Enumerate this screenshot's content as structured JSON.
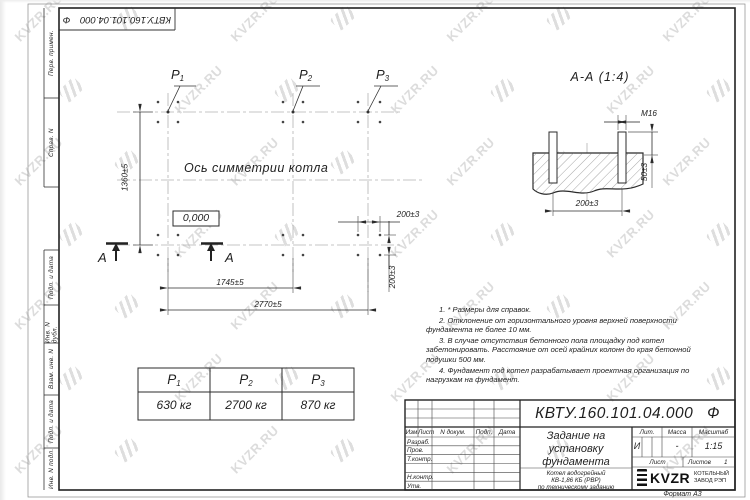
{
  "watermark": {
    "text": "KVZR.RU"
  },
  "doc_number": "КВТУ.160.101.04.000",
  "doc_suffix": "Ф",
  "sidebar": {
    "cells": [
      "Перв. примен.",
      "Справ. N",
      "Подп. и дата",
      "Инв. N дубл.",
      "Взам. инв. N",
      "Подп. и дата",
      "Инв. N подл."
    ]
  },
  "plan": {
    "loads": [
      {
        "base": "P",
        "sub": "1"
      },
      {
        "base": "P",
        "sub": "2"
      },
      {
        "base": "P",
        "sub": "3"
      }
    ],
    "axis_label": "Ось симметрии котла",
    "level_mark": "0,000",
    "section_letter": "А",
    "dim_height": "1360±5",
    "dim_span_inner": "1745±5",
    "dim_span_outer": "2770±5",
    "dim_bolt_x": "200±3",
    "dim_bolt_y": "200±3"
  },
  "section": {
    "title": "А-А (1:4)",
    "thread": "М16",
    "dim_spacing": "200±3",
    "dim_height": "50±3"
  },
  "notes": [
    "1. * Размеры для справок.",
    "2. Отклонение от горизонтального уровня верхней поверхности фундамента не более 10 мм.",
    "3. В случае отсутствия бетонного пола площадку под котел забетонировать. Расстояние от осей крайних колонн до края бетонной подушки 500 мм.",
    "4. Фундамент под котел разрабатывает проектная организация по нагрузкам на фундамент."
  ],
  "load_table": {
    "values": [
      "630 кг",
      "2700 кг",
      "870 кг"
    ]
  },
  "title_block": {
    "rev_headers": [
      "Изм",
      "Лист",
      "N докум.",
      "Подп.",
      "Дата"
    ],
    "roles": [
      "Разраб.",
      "Пров.",
      "Т.контр.",
      "",
      "Н.контр.",
      "Утв."
    ],
    "title_lines": [
      "Задание на",
      "установку",
      "фундамента"
    ],
    "subtitle_lines": [
      "Котел водогрейный",
      "КВ-1,86 КБ (РВР)",
      "по техническому заданию"
    ],
    "lit_header": "Лит.",
    "mass_header": "Масса",
    "scale_header": "Масштаб",
    "lit_value": "И",
    "mass_value": "-",
    "scale_value": "1:15",
    "sheet_label": "Лист",
    "sheets_label": "Листов",
    "sheets_value": "1",
    "logo_text": "KVZR",
    "company_line1": "КОТЕЛЬНЫЙ",
    "company_line2": "ЗАВОД РЭП",
    "format_label": "Формат А3"
  }
}
